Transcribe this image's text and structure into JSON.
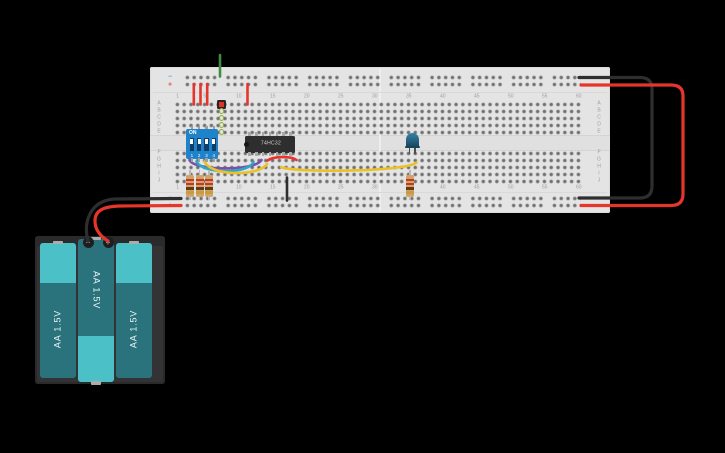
{
  "canvas": {
    "background": "#000000"
  },
  "breadboard": {
    "body_color": "#e4e4e4",
    "column_labels": [
      "1",
      "5",
      "10",
      "15",
      "20",
      "25",
      "30",
      "35",
      "40",
      "45",
      "50",
      "55",
      "60"
    ],
    "row_labels_top": [
      "A",
      "B",
      "C",
      "D",
      "E"
    ],
    "row_labels_bottom": [
      "F",
      "G",
      "H",
      "I",
      "J"
    ],
    "rail_minus": "−",
    "rail_plus": "+"
  },
  "components": {
    "dip_switch": {
      "on_label": "ON",
      "positions": [
        "1",
        "2",
        "3",
        "4"
      ],
      "body_color": "#1f83cc"
    },
    "ic": {
      "label": "74HC32",
      "body_color": "#2e2e2e"
    },
    "led": {
      "color": "#255f7e"
    },
    "resistors": {
      "body_color": "#d2a368",
      "band_colors": [
        "#c03a27",
        "#c03a27",
        "#5f3a1c",
        "#c89b3c"
      ]
    },
    "pushbutton": {
      "color": "#e33225"
    },
    "battery_pack": {
      "cells": [
        {
          "label": "AA 1.5V"
        },
        {
          "label": "AA 1.5V"
        },
        {
          "label": "AA 1.5V"
        }
      ],
      "terminal_minus": "−",
      "terminal_plus": "+",
      "case_color": "#333335",
      "cell_dark": "#2b737c",
      "cell_light": "#4bc0c6"
    }
  },
  "wire_colors": {
    "red": "#e6352b",
    "black": "#2e2e30",
    "yellow": "#e9c229",
    "purple": "#7b4fa6",
    "cyan": "#2ba7c9",
    "green": "#3d8c40"
  }
}
